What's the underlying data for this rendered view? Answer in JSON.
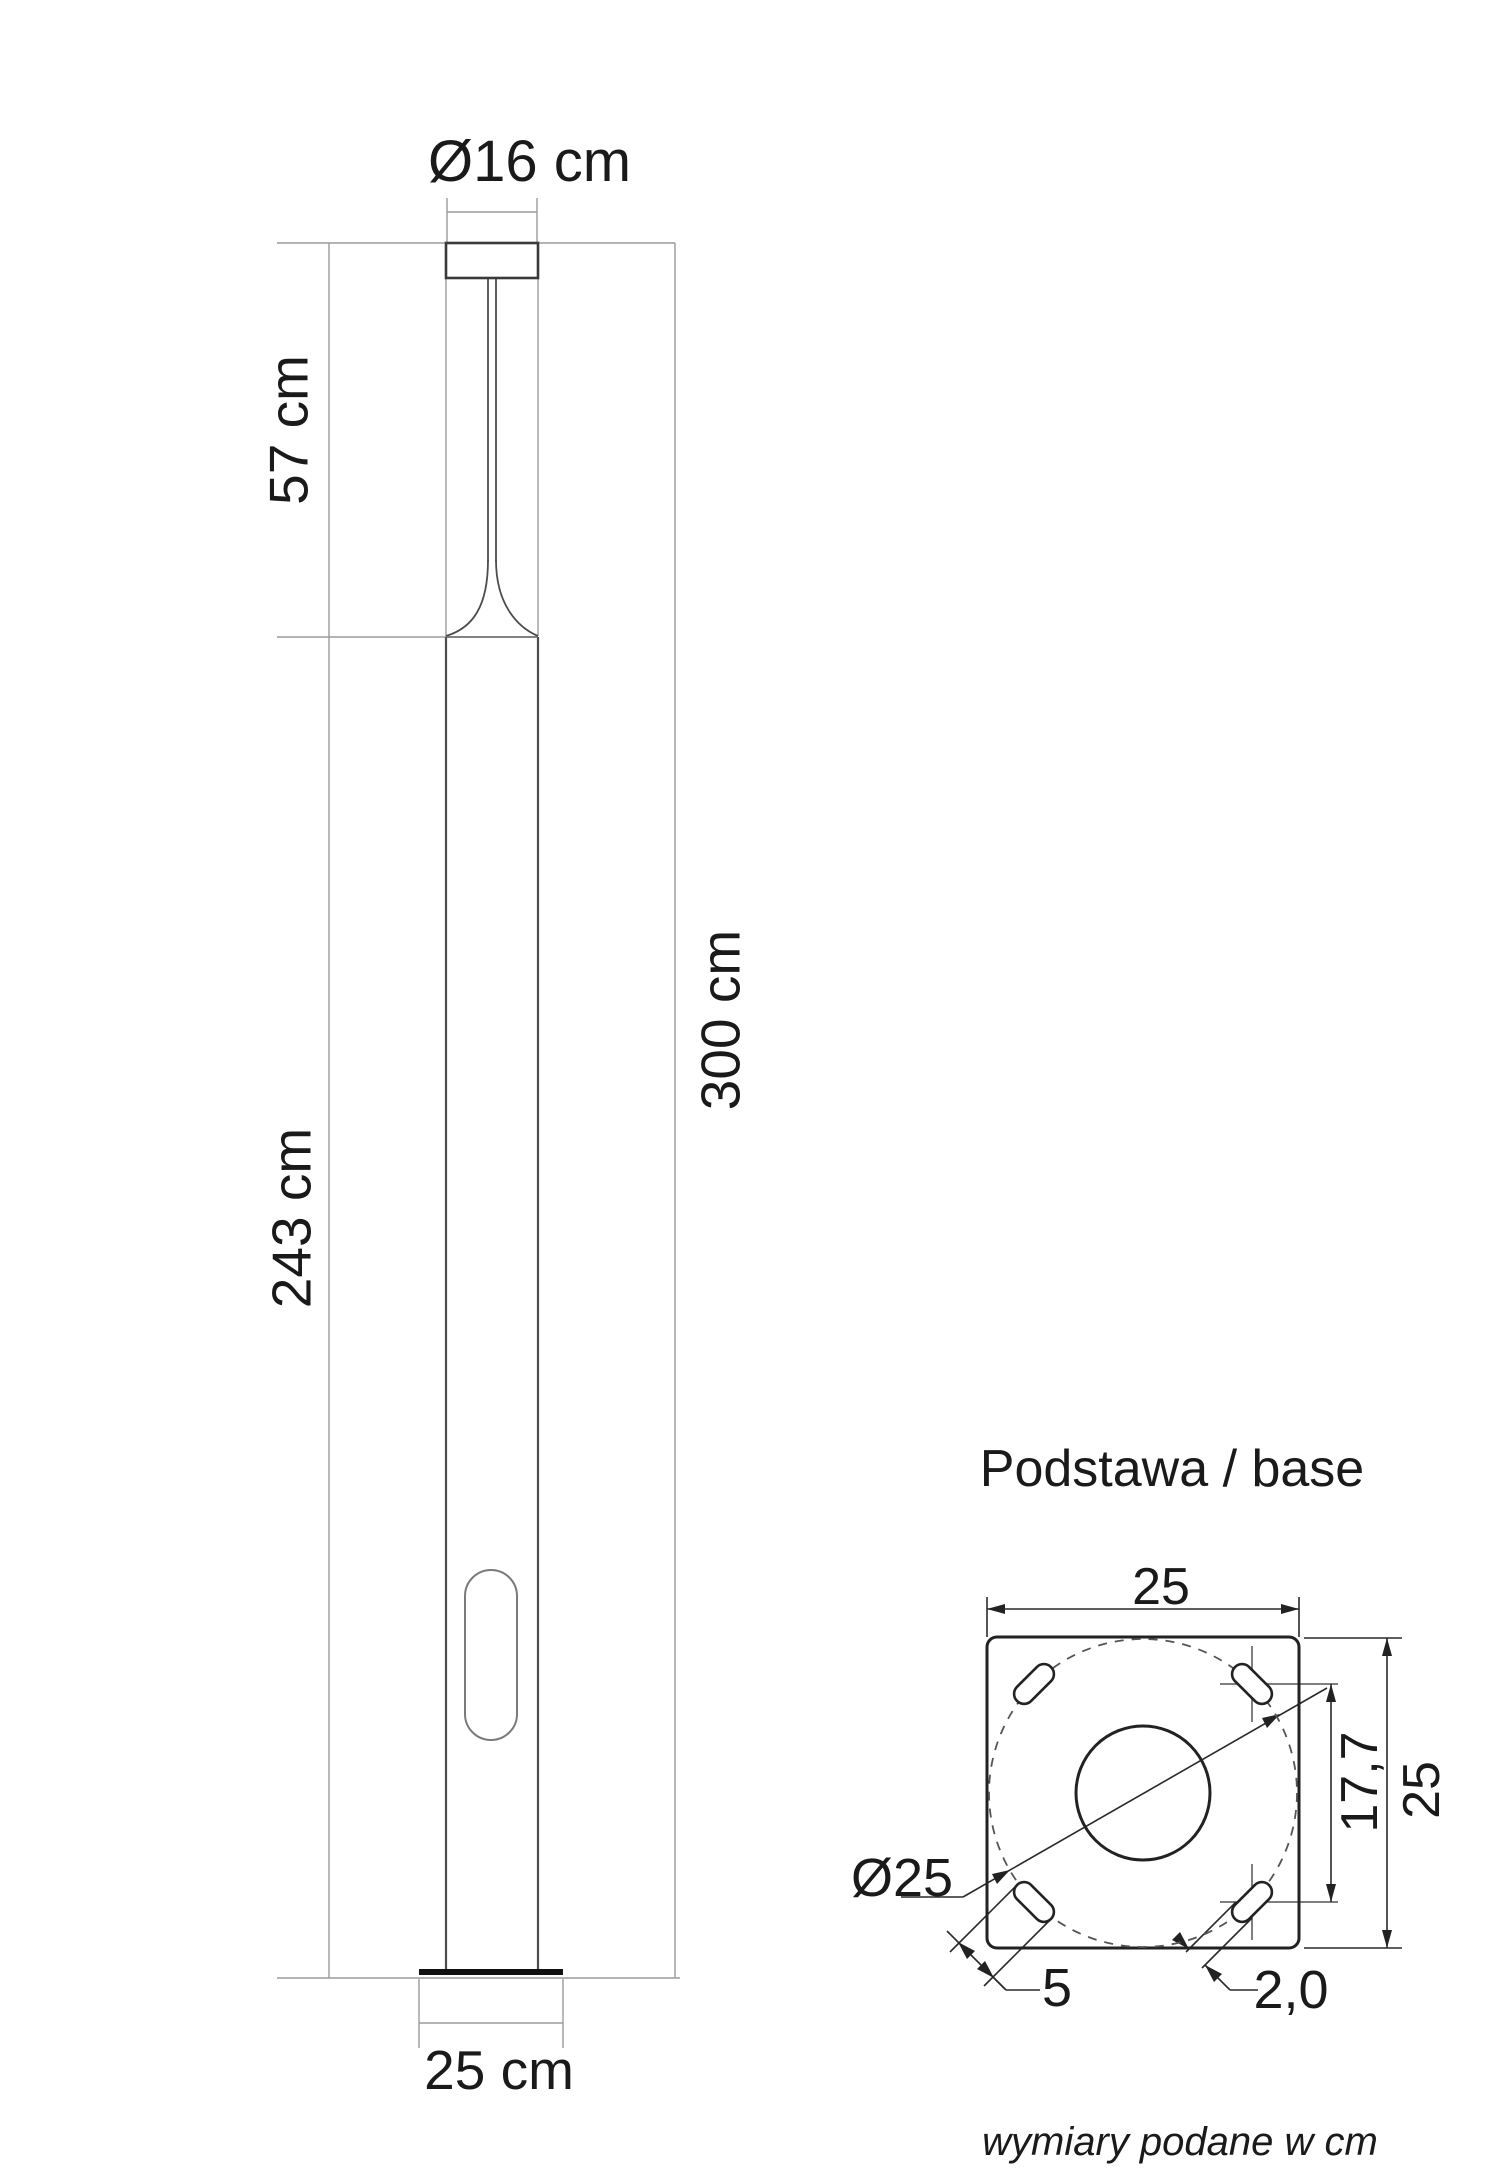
{
  "main_view": {
    "labels": {
      "cap_diameter": "Ø16 cm",
      "upper_section_height": "57 cm",
      "lower_section_height": "243 cm",
      "total_height": "300 cm",
      "base_width": "25 cm"
    }
  },
  "base_detail": {
    "title": "Podstawa / base",
    "labels": {
      "plate_width_top": "25",
      "plate_height_right": "25",
      "bolt_hole_spacing": "17,7",
      "bolt_circle_diameter": "Ø25",
      "slot_length": "5",
      "slot_width": "2,0"
    }
  },
  "footer": {
    "units_note": "wymiary podane w cm"
  },
  "colors": {
    "background": "#ffffff",
    "object_line": "#4d4d4d",
    "detail_line": "#222222",
    "dimension_line": "#9b9b9b",
    "base_plate": "#111111",
    "text": "#1a1a1a"
  }
}
